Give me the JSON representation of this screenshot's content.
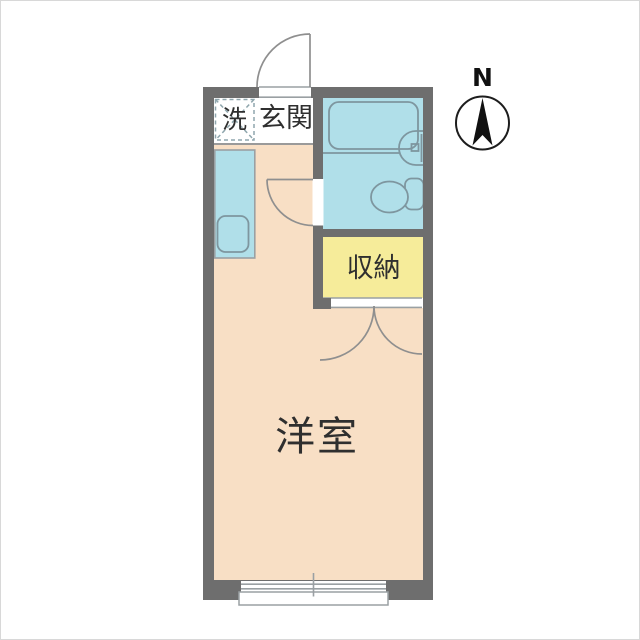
{
  "floorplan": {
    "compass": {
      "north_label": "N"
    },
    "rooms": {
      "main_room": {
        "label": "洋室"
      },
      "entrance": {
        "label": "玄関"
      },
      "closet": {
        "label": "収納"
      },
      "laundry": {
        "label": "洗"
      }
    },
    "fixtures": [
      "bathtub",
      "wash-basin",
      "toilet",
      "kitchen-sink",
      "washing-machine-space",
      "entrance-door",
      "bathroom-door",
      "closet-double-doors",
      "sliding-window",
      "balcony"
    ],
    "colors": {
      "wall": "#6e6e6e",
      "water": "#b0dfe9",
      "room": "#f8dfc5",
      "closet": "#f6ec9a",
      "fixture_line": "#7e969f",
      "thin_line": "#9aa0a3",
      "door_line": "#8f8f8f",
      "dash_line": "#8fa6ad",
      "step_line": "#9a9a9a",
      "text": "#2f2f2f"
    }
  }
}
